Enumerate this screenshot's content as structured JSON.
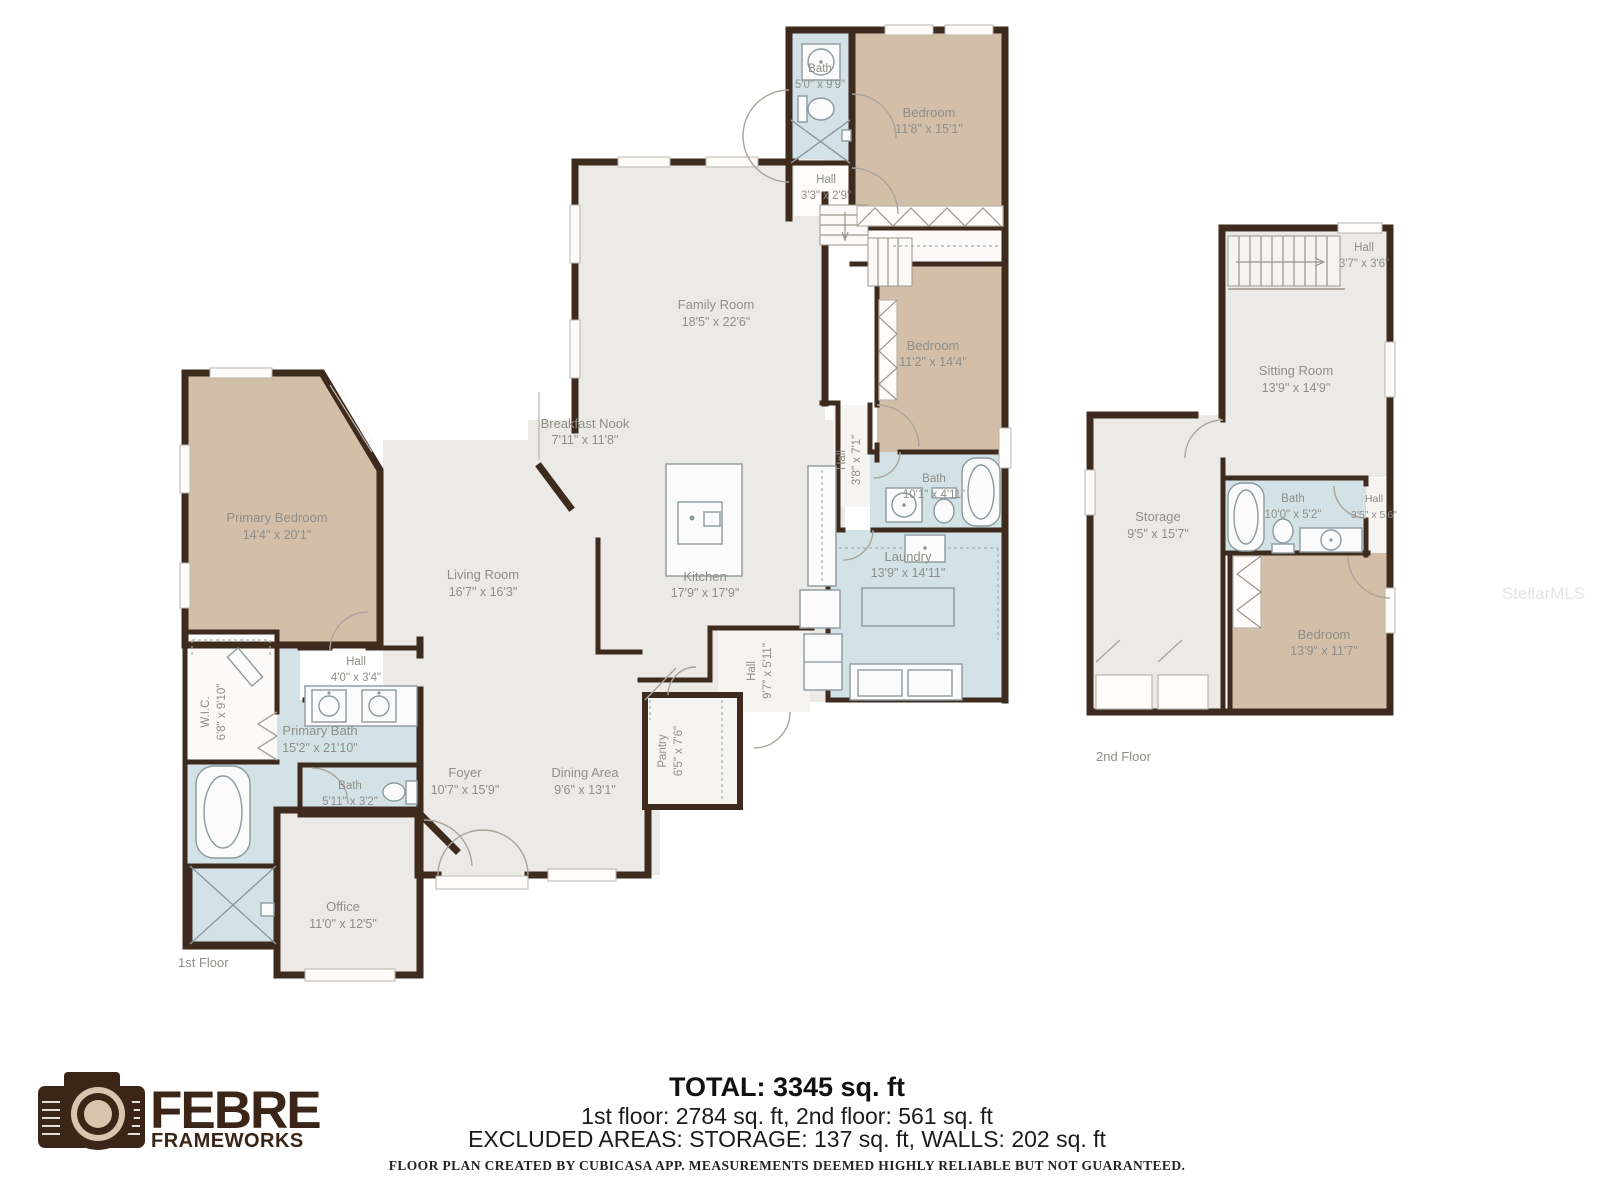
{
  "watermark": "StellarMLS",
  "colors": {
    "wall": "#3E2B1D",
    "bedroom_fill": "#D3BFA8",
    "wet_room_fill": "#D2E2E7",
    "floor_fill": "#ECEAE6",
    "label_text": "#8F8E88",
    "logo_brown": "#3B2516",
    "logo_beige": "#D8C5AD"
  },
  "floors": [
    {
      "name": "1st Floor",
      "rooms": [
        {
          "label": "Bath",
          "dims": "5'0\" x 9'9\""
        },
        {
          "label": "Bedroom",
          "dims": "11'8\" x 15'1\""
        },
        {
          "label": "Hall",
          "dims": "3'3\" x 2'9\""
        },
        {
          "label": "Family Room",
          "dims": "18'5\" x 22'6\""
        },
        {
          "label": "Bedroom",
          "dims": "11'2\" x 14'4\""
        },
        {
          "label": "Breakfast Nook",
          "dims": "7'11\" x 11'8\""
        },
        {
          "label": "Hall",
          "dims": "3'8\" x 7'1\""
        },
        {
          "label": "Bath",
          "dims": "10'1\" x 4'11\""
        },
        {
          "label": "Laundry",
          "dims": "13'9\" x 14'11\""
        },
        {
          "label": "Primary Bedroom",
          "dims": "14'4\" x 20'1\""
        },
        {
          "label": "Living Room",
          "dims": "16'7\" x 16'3\""
        },
        {
          "label": "Kitchen",
          "dims": "17'9\" x 17'9\""
        },
        {
          "label": "W.I.C.",
          "dims": "6'8\" x 9'10\""
        },
        {
          "label": "Hall",
          "dims": "4'0\" x 3'4\""
        },
        {
          "label": "Primary Bath",
          "dims": "15'2\" x 21'10\""
        },
        {
          "label": "Bath",
          "dims": "5'11\" x 3'2\""
        },
        {
          "label": "Foyer",
          "dims": "10'7\" x 15'9\""
        },
        {
          "label": "Dining Area",
          "dims": "9'6\" x 13'1\""
        },
        {
          "label": "Pantry",
          "dims": "6'5\" x 7'6\""
        },
        {
          "label": "Hall",
          "dims": "9'7\" x 5'11\""
        },
        {
          "label": "Office",
          "dims": "11'0\" x 12'5\""
        }
      ]
    },
    {
      "name": "2nd Floor",
      "rooms": [
        {
          "label": "Hall",
          "dims": "3'7\" x 3'6\""
        },
        {
          "label": "Sitting Room",
          "dims": "13'9\" x 14'9\""
        },
        {
          "label": "Storage",
          "dims": "9'5\" x 15'7\""
        },
        {
          "label": "Bath",
          "dims": "10'0\" x 5'2\""
        },
        {
          "label": "Hall",
          "dims": "3'5\" x 5'6\""
        },
        {
          "label": "Bedroom",
          "dims": "13'9\" x 11'7\""
        }
      ]
    }
  ],
  "summary": {
    "total": "TOTAL: 3345 sq. ft",
    "floors_line": "1st floor: 2784 sq. ft, 2nd floor: 561 sq. ft",
    "excluded_line": "EXCLUDED AREAS: STORAGE: 137 sq. ft, WALLS: 202 sq. ft",
    "disclaimer": "FLOOR PLAN CREATED BY CUBICASA APP. MEASUREMENTS DEEMED HIGHLY RELIABLE BUT NOT GUARANTEED."
  },
  "logo": {
    "name": "FEBRE",
    "sub": "FRAMEWORKS"
  }
}
